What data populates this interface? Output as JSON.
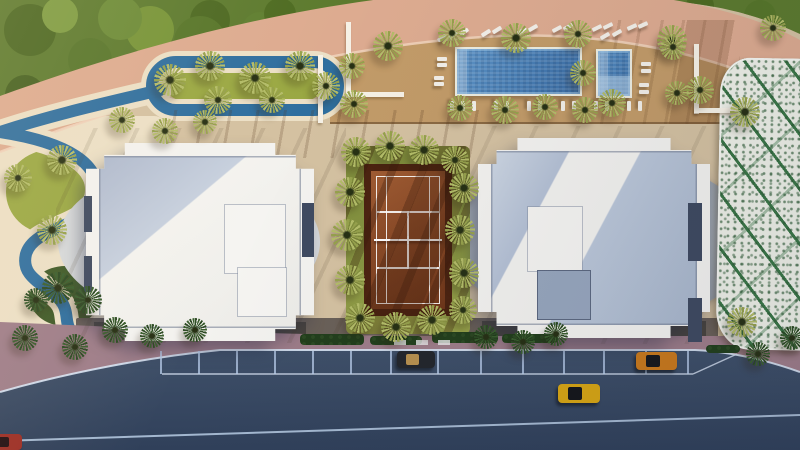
{
  "colors": {
    "sand": "#d4c1a1",
    "cream": "#ece0c6",
    "deck": "#c29b68",
    "band": "#ddab90",
    "foliage": "#5c7a2e",
    "river": "#2f6f9f",
    "walk": "#9e7d89",
    "road_top": "#3f5069",
    "road_bottom": "#30405a",
    "lane": "#b8cce4",
    "curb": "#d8e4f4",
    "lawn": "#879441",
    "clay": "#8a4a26",
    "court_border": "#4c2310",
    "bwhite": "#f3f2ef",
    "broof_blue": "#b4c0d4",
    "podium": "#9aa2ac",
    "lattice": "#eef0e7",
    "lattice_green": "#3a7646",
    "palm_olive": "#96a14c",
    "palm_dark": "#2c4a23",
    "hedge": "#223f1c"
  },
  "scene": {
    "palms": [
      [
        388,
        46,
        15,
        "o"
      ],
      [
        452,
        33,
        14,
        "o"
      ],
      [
        516,
        38,
        15,
        "o"
      ],
      [
        578,
        34,
        14,
        "o"
      ],
      [
        583,
        73,
        13,
        "o"
      ],
      [
        612,
        103,
        14,
        "o"
      ],
      [
        672,
        40,
        15,
        "o"
      ],
      [
        700,
        90,
        14,
        "o"
      ],
      [
        352,
        66,
        13,
        "o"
      ],
      [
        354,
        104,
        14,
        "o"
      ],
      [
        460,
        108,
        13,
        "o"
      ],
      [
        505,
        110,
        14,
        "o"
      ],
      [
        545,
        107,
        13,
        "o"
      ],
      [
        585,
        110,
        13,
        "o"
      ],
      [
        170,
        80,
        16,
        "o"
      ],
      [
        210,
        66,
        15,
        "o"
      ],
      [
        255,
        78,
        16,
        "o"
      ],
      [
        300,
        66,
        15,
        "o"
      ],
      [
        326,
        86,
        14,
        "o"
      ],
      [
        218,
        100,
        14,
        "o"
      ],
      [
        272,
        100,
        13,
        "o"
      ],
      [
        122,
        120,
        13,
        "o"
      ],
      [
        165,
        131,
        13,
        "o"
      ],
      [
        205,
        122,
        12,
        "o"
      ],
      [
        18,
        178,
        14,
        "o"
      ],
      [
        62,
        160,
        15,
        "o"
      ],
      [
        52,
        230,
        15,
        "o"
      ],
      [
        58,
        288,
        16,
        "d"
      ],
      [
        88,
        300,
        14,
        "d"
      ],
      [
        36,
        300,
        12,
        "d"
      ],
      [
        25,
        338,
        13,
        "d"
      ],
      [
        75,
        347,
        13,
        "d"
      ],
      [
        115,
        330,
        13,
        "d"
      ],
      [
        152,
        336,
        12,
        "d"
      ],
      [
        195,
        330,
        12,
        "d"
      ],
      [
        356,
        152,
        15,
        "o"
      ],
      [
        390,
        146,
        15,
        "o"
      ],
      [
        424,
        150,
        15,
        "o"
      ],
      [
        455,
        160,
        14,
        "o"
      ],
      [
        350,
        192,
        15,
        "o"
      ],
      [
        347,
        235,
        16,
        "o"
      ],
      [
        350,
        280,
        15,
        "o"
      ],
      [
        464,
        188,
        15,
        "o"
      ],
      [
        460,
        230,
        15,
        "o"
      ],
      [
        464,
        273,
        15,
        "o"
      ],
      [
        360,
        318,
        15,
        "o"
      ],
      [
        396,
        327,
        15,
        "o"
      ],
      [
        432,
        320,
        15,
        "o"
      ],
      [
        463,
        310,
        14,
        "o"
      ],
      [
        486,
        337,
        12,
        "d"
      ],
      [
        523,
        342,
        12,
        "d"
      ],
      [
        556,
        334,
        12,
        "d"
      ],
      [
        745,
        112,
        15,
        "o"
      ],
      [
        742,
        322,
        15,
        "o"
      ],
      [
        758,
        354,
        12,
        "d"
      ],
      [
        792,
        338,
        12,
        "d"
      ],
      [
        773,
        28,
        13,
        "o"
      ],
      [
        673,
        47,
        13,
        "o"
      ],
      [
        677,
        93,
        12,
        "o"
      ]
    ],
    "loungers": [
      [
        437,
        36,
        -35
      ],
      [
        448,
        33,
        -35
      ],
      [
        459,
        30,
        -35
      ],
      [
        481,
        31,
        -32
      ],
      [
        492,
        28,
        -32
      ],
      [
        517,
        29,
        -30
      ],
      [
        528,
        26,
        -30
      ],
      [
        552,
        27,
        -28
      ],
      [
        563,
        25,
        -28
      ],
      [
        592,
        26,
        -26
      ],
      [
        603,
        24,
        -26
      ],
      [
        627,
        25,
        -24
      ],
      [
        638,
        23,
        -24
      ],
      [
        437,
        57,
        0
      ],
      [
        437,
        63,
        0
      ],
      [
        434,
        76,
        0
      ],
      [
        434,
        82,
        0
      ],
      [
        447,
        104,
        90
      ],
      [
        458,
        104,
        90
      ],
      [
        469,
        104,
        90
      ],
      [
        491,
        104,
        90
      ],
      [
        502,
        104,
        90
      ],
      [
        524,
        104,
        90
      ],
      [
        535,
        104,
        90
      ],
      [
        558,
        104,
        90
      ],
      [
        569,
        104,
        90
      ],
      [
        591,
        104,
        90
      ],
      [
        602,
        104,
        90
      ],
      [
        624,
        104,
        90
      ],
      [
        635,
        104,
        90
      ],
      [
        641,
        62,
        0
      ],
      [
        641,
        69,
        0
      ],
      [
        639,
        83,
        0
      ],
      [
        639,
        90,
        0
      ],
      [
        600,
        34,
        -30
      ],
      [
        612,
        31,
        -30
      ]
    ],
    "parking_separators": [
      160,
      198,
      236,
      274,
      312,
      350,
      390,
      437,
      480,
      522,
      563,
      603,
      645,
      687
    ],
    "cars": [
      {
        "name": "parked-dark-convertible",
        "x": 397,
        "y": 351,
        "w": 38,
        "h": 17,
        "body": "#23262b",
        "glass": "#b8914f"
      },
      {
        "name": "parked-orange-car",
        "x": 636,
        "y": 352,
        "w": 41,
        "h": 18,
        "body": "#c9791c",
        "glass": "#17181c"
      },
      {
        "name": "moving-yellow-taxi",
        "x": 558,
        "y": 384,
        "w": 42,
        "h": 19,
        "body": "#d7a513",
        "glass": "#15161a"
      },
      {
        "name": "red-car-corner",
        "x": -10,
        "y": 434,
        "w": 32,
        "h": 16,
        "body": "#9c2e25",
        "glass": "#241012"
      }
    ]
  }
}
